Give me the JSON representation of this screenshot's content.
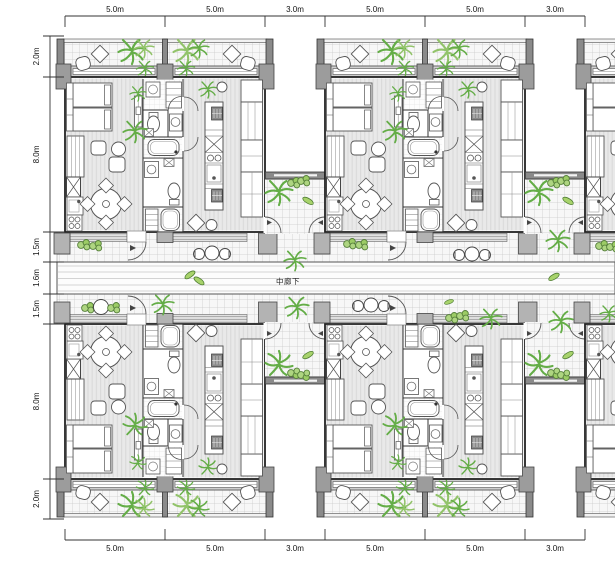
{
  "plan": {
    "corridor": {
      "label": "中廊下"
    },
    "dimensions": {
      "top": [
        "5.0m",
        "5.0m",
        "3.0m",
        "5.0m",
        "5.0m",
        "3.0m"
      ],
      "bottom": [
        "5.0m",
        "5.0m",
        "3.0m",
        "5.0m",
        "5.0m",
        "3.0m"
      ],
      "left": [
        "2.0m",
        "8.0m",
        "1.5m",
        "1.6m",
        "1.5m",
        "8.0m",
        "2.0m"
      ]
    },
    "colors": {
      "wall_gray": "#b3b3b3",
      "pillar_gray": "#9c9c9c",
      "end_wall_gray": "#8a8a8a",
      "floor_gray": "#eaeaea",
      "tile_line": "#c9c9c9",
      "plant_green": "#64ad47",
      "plant_light_green": "#92c36a",
      "dim_text": "#111111"
    }
  }
}
